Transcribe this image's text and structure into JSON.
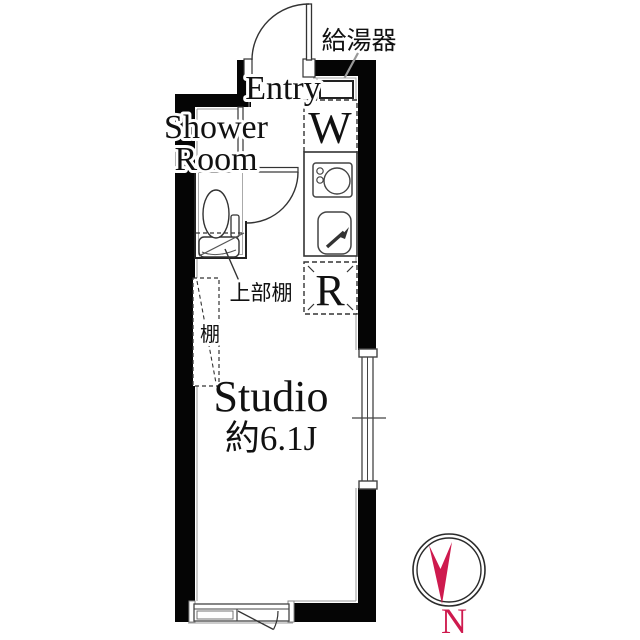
{
  "rooms": {
    "entry_label": "Entry",
    "shower_line1": "Shower",
    "shower_line2": "Room",
    "studio_label": "Studio",
    "studio_area": "約6.1J"
  },
  "appliances": {
    "water_heater_label": "給湯器",
    "washer_letter": "W",
    "refrigerator_letter": "R"
  },
  "storage": {
    "upper_shelf_label": "上部棚",
    "shelf_label": "棚"
  },
  "compass": {
    "north_label": "N",
    "needle_color": "#ce1a4e"
  },
  "colors": {
    "wall": "#050505",
    "line": "#3a3a3a",
    "thin_gray": "#999999"
  }
}
